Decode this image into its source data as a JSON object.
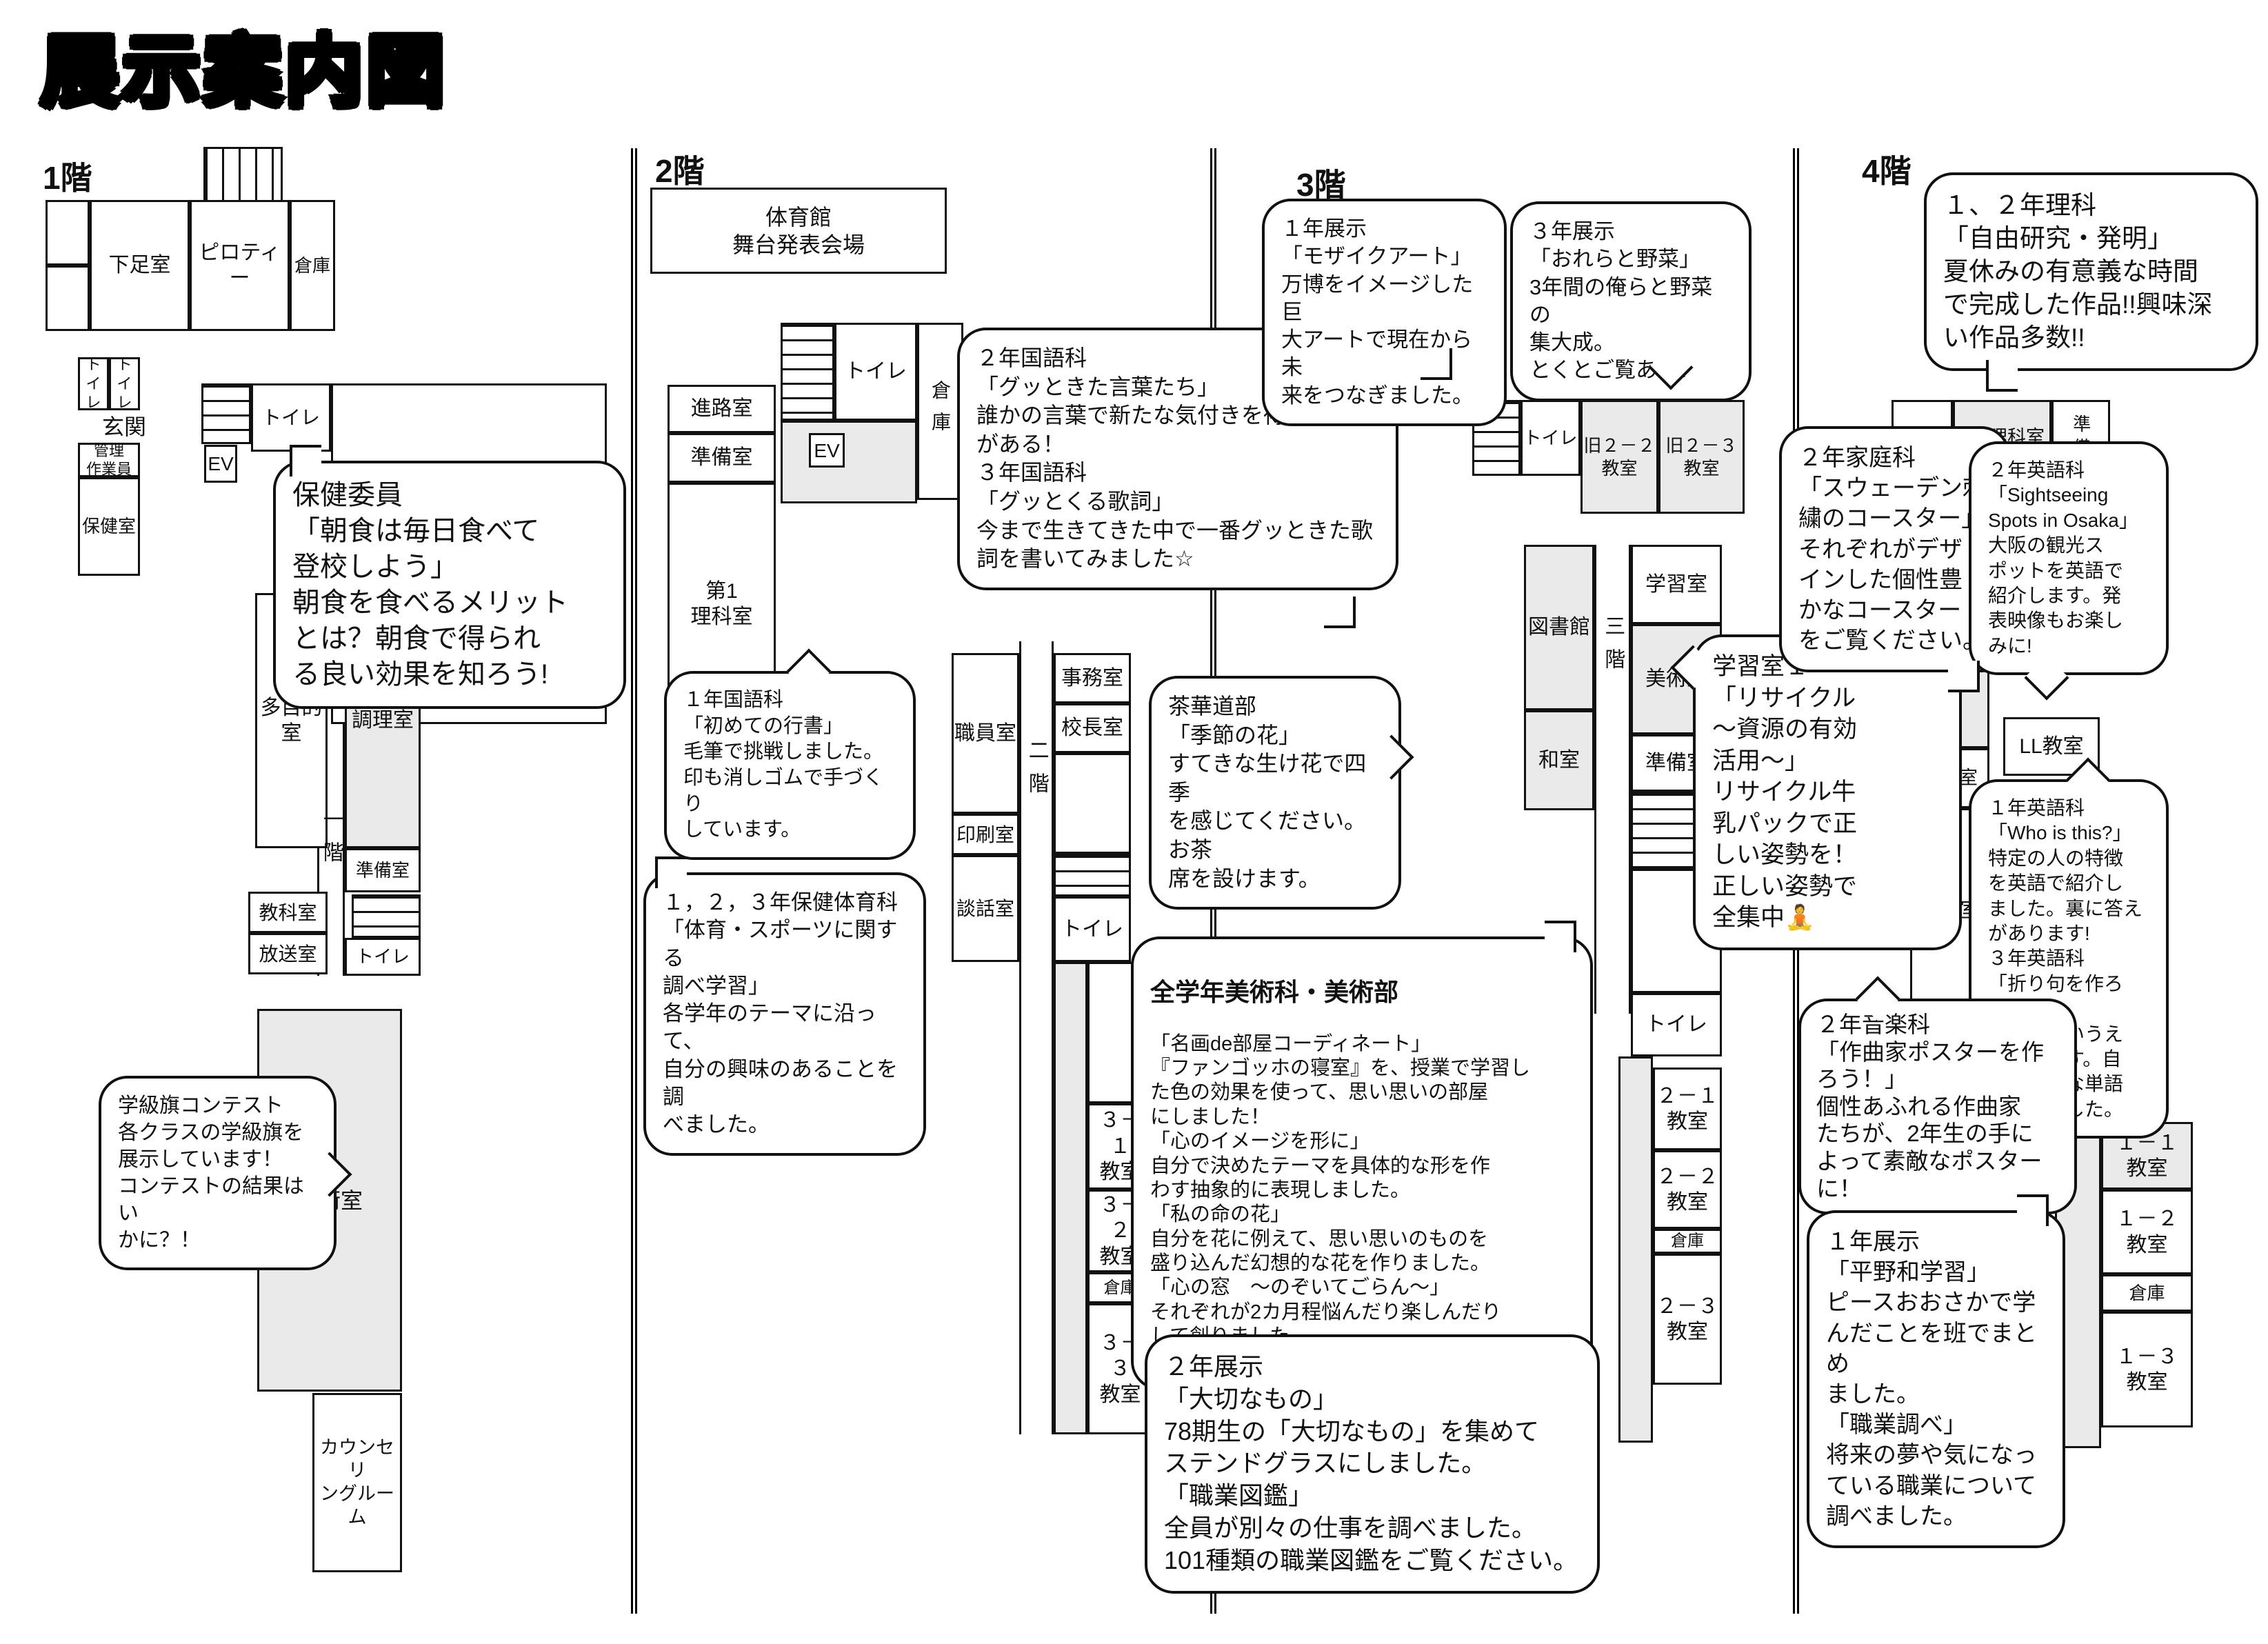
{
  "title": "展示案内図",
  "floors": {
    "f1": {
      "label": "1階",
      "rooms": {
        "shoe": "下足室",
        "piloti": "ピロティー",
        "souko_top": "倉庫",
        "toilet_a": "トイレ",
        "toilet_b": "トイレ",
        "genkan": "玄関",
        "kanri": "管理\n作業員",
        "hoken": "保健室",
        "ev": "EV",
        "toilet_c": "トイレ",
        "tamokuteki": "多目的\n室",
        "ikkai": "一階",
        "chouri": "調理室",
        "junbi": "準備室",
        "kyouka": "教科室",
        "housou": "放送室",
        "toilet_d": "トイレ",
        "gijutsu": "技術室",
        "counseling": "カウンセリ\nングルーム"
      }
    },
    "f2": {
      "label": "2階",
      "rooms": {
        "taiikukan": "体育館\n舞台発表会場",
        "shinro": "進路室",
        "junbi": "準備室",
        "rika1": "第1\n理科室",
        "toilet_a": "トイレ",
        "souko_a": "倉庫",
        "ev": "EV",
        "shokuin": "職員室",
        "nikai": "二階",
        "jimu": "事務室",
        "kouchou": "校長室",
        "insatsu": "印刷室",
        "danwa": "談話室",
        "toilet_b": "トイレ",
        "c31": "３－１\n教室",
        "c32": "３－２\n教室",
        "souko_b": "倉庫",
        "c33": "３－３\n教室"
      }
    },
    "f3": {
      "label": "3階",
      "rooms": {
        "toilet_a": "トイレ",
        "old22": "旧２－２\n教室",
        "old23": "旧２－３\n教室",
        "tosho": "図書館",
        "sankai": "三階",
        "gakushu": "学習室",
        "bijutsu": "美術室",
        "washitsu": "和室",
        "junbi": "準備室",
        "toilet_b": "トイレ",
        "c21": "２－１\n教室",
        "c22": "２－２\n教室",
        "souko": "倉庫",
        "c23": "２－３\n教室"
      }
    },
    "f4": {
      "label": "4階",
      "rooms": {
        "toilet": "トイレ",
        "rika2": "第2理科室",
        "junbi_v": "準備",
        "hifuku": "被服室",
        "ll": "LL教室",
        "junbi": "準備室",
        "ongaku": "音楽室",
        "c11": "１－１\n教室",
        "c12": "１－２\n教室",
        "souko": "倉庫",
        "c13": "１－３\n教室"
      }
    }
  },
  "bubbles": {
    "hoken_iin": {
      "text": "保健委員\n「朝食は毎日食べて\n登校しよう」\n朝食を食べるメリット\nとは？朝食で得られ\nる良い効果を知ろう!"
    },
    "gakkyuki": {
      "text": "学級旗コンテスト\n各クラスの学級旗を\n展示しています！\nコンテストの結果はい\nかに？！"
    },
    "kokugo1": {
      "text": "１年国語科\n「初めての行書」\n毛筆で挑戦しました。\n印も消しゴムで手づくり\nしています。"
    },
    "hotaiiku": {
      "text": "１，２，３年保健体育科\n「体育・スポーツに関する\n調べ学習」\n各学年のテーマに沿って、\n自分の興味のあることを調\nべました。"
    },
    "kokugo23": {
      "text": "２年国語科\n「グッときた言葉たち」\n誰かの言葉で新たな気付きを得ること\nがある！\n３年国語科\n「グッとくる歌詞」\n今まで生きてきた中で一番グッときた歌\n詞を書いてみました☆"
    },
    "sakadou": {
      "text": "茶華道部\n「季節の花」\nすてきな生け花で四季\nを感じてください。お茶\n席を設けます。"
    },
    "bijutsu": {
      "header": "全学年美術科・美術部",
      "body": "「名画de部屋コーディネート」\n『ファンゴッホの寝室』を、授業で学習し\nた色の効果を使って、思い思いの部屋\nにしました！\n「心のイメージを形に」\n自分で決めたテーマを具体的な形を作\nわす抽象的に表現しました。\n「私の命の花」\n自分を花に例えて、思い思いのものを\n盛り込んだ幻想的な花を作りました。\n「心の窓　～のぞいてごらん～」\nそれぞれが2カ月程悩んだり楽しんだり\nして創りました。"
    },
    "tenji2": {
      "text": "２年展示\n「大切なもの」\n78期生の「大切なもの」を集めて\nステンドグラスにしました。\n「職業図鑑」\n全員が別々の仕事を調べました。\n101種類の職業図鑑をご覧ください。"
    },
    "tenji1_mosaic": {
      "text": "１年展示\n「モザイクアート」\n万博をイメージした巨\n大アートで現在から未\n来をつなぎました。"
    },
    "tenji3_yasai": {
      "text": "３年展示\n「おれらと野菜」\n3年間の俺らと野菜の\n集大成。\nとくとご覧あれ！"
    },
    "gakushu1": {
      "text": "学習室１\n「リサイクル\n～資源の有効\n活用～」\nリサイクル牛\n乳パックで正\nしい姿勢を！\n正しい姿勢で\n全集中🧘"
    },
    "rika12": {
      "text": "１、２年理科\n「自由研究・発明」\n夏休みの有意義な時間\nで完成した作品!!興味深\nい作品多数!!"
    },
    "katei": {
      "text": "２年家庭科\n「スウェーデン刺\n繍のコースター」\nそれぞれがデザ\nインした個性豊\nかなコースター\nをご覧ください。"
    },
    "eigo2": {
      "text": "２年英語科\n「Sightseeing\nSpots in Osaka」\n大阪の観光ス\nポットを英語で\n紹介します。発\n表映像もお楽し\nみに!"
    },
    "eigo13": {
      "text": "１年英語科\n「Who is this?」\n特定の人の特徴\nを英語で紹介し\nました。裏に答え\nがあります!\n３年英語科\n「折り句を作ろう」\n英語版あいうえ\nお作文です。自\n分の好きな単語\nで作りました。"
    },
    "ongaku2": {
      "text": "２年音楽科\n「作曲家ポスターを作\nろう！」\n個性あふれる作曲家\nたちが、2年生の手に\nよって素敵なポスター\nに！"
    },
    "hirano": {
      "text": "１年展示\n「平野和学習」\nピースおおさかで学\nんだことを班でまとめ\nました。\n「職業調べ」\n将来の夢や気になっ\nている職業について\n調べました。"
    }
  }
}
